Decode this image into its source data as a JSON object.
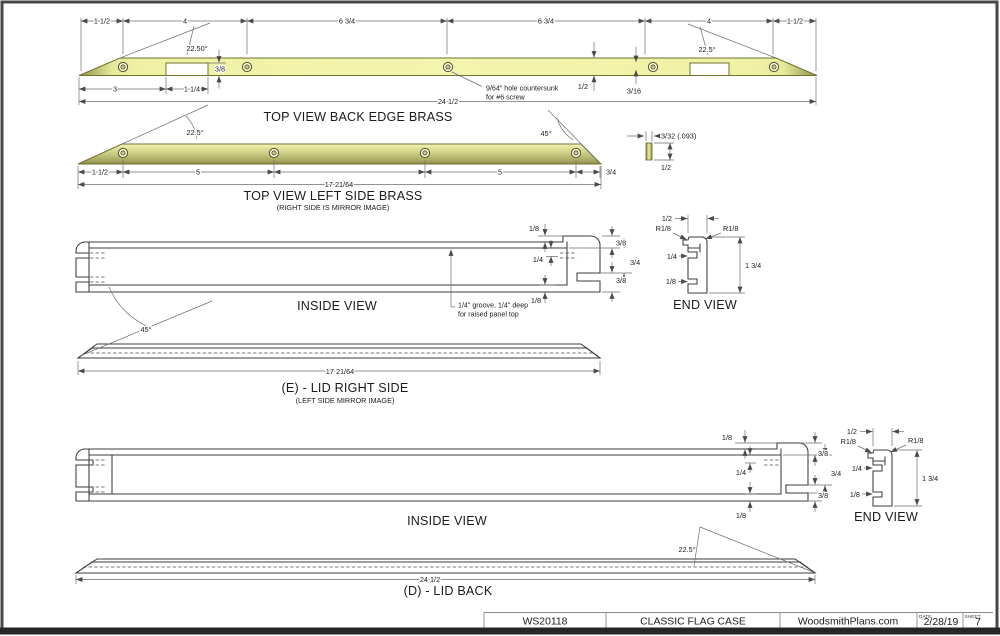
{
  "back_edge": {
    "title": "TOP VIEW BACK EDGE BRASS",
    "seg1": "1 1/2",
    "seg2": "4",
    "seg3": "6 3/4",
    "seg4": "6 3/4",
    "seg5": "4",
    "seg6": "1 1/2",
    "angle_left": "22.50°",
    "angle_right": "22.5°",
    "notch_depth": "3/8",
    "tip_to_notch": "3",
    "notch_width": "1 1/4",
    "bar_width": "1/2",
    "hole_inset": "3/16",
    "overall": "24 1/2",
    "hole_note_1": "9/64\" hole countersunk",
    "hole_note_2": "for #6 screw"
  },
  "left_side": {
    "title": "TOP VIEW LEFT SIDE BRASS",
    "subtitle": "(RIGHT SIDE IS MIRROR IMAGE)",
    "angle_left": "22.5°",
    "angle_right": "45°",
    "seg1": "1 1/2",
    "seg2": "5",
    "seg3": "5",
    "seg4": "3/4",
    "overall": "17 21/64"
  },
  "strip": {
    "thickness": "3/32 (.093)",
    "width": "1/2"
  },
  "lid_side": {
    "inside_label": "INSIDE VIEW",
    "top_lip": "1/8",
    "cap_step": "3/8",
    "groove_depth": "1/4",
    "mid": "3/4",
    "lower_step": "3/8",
    "bottom_lip": "1/8",
    "groove_note_1": "1/4\" groove, 1/4\" deep",
    "groove_note_2": "for raised panel top",
    "end": {
      "label": "END VIEW",
      "width": "1/2",
      "radius_left": "R1/8",
      "radius_right": "R1/8",
      "groove": "1/4",
      "lip": "1/8",
      "height": "1 3/4"
    },
    "angle": "45°",
    "overall": "17 21/64",
    "title": "(E) - LID RIGHT SIDE",
    "subtitle": "(LEFT SIDE MIRROR IMAGE)"
  },
  "lid_back": {
    "inside_label": "INSIDE VIEW",
    "top_lip": "1/8",
    "cap_step": "3/8",
    "groove_depth": "1/4",
    "mid": "3/4",
    "lower_step": "3/8",
    "bottom_lip": "1/8",
    "end": {
      "label": "END VIEW",
      "width": "1/2",
      "radius_left": "R1/8",
      "radius_right": "R1/8",
      "groove": "1/4",
      "lip": "1/8",
      "height": "1 3/4"
    },
    "angle": "22.5°",
    "overall": "24 1/2",
    "title": "(D) - LID BACK"
  },
  "title_block": {
    "code": "WS20118",
    "name": "CLASSIC FLAG CASE",
    "site": "WoodsmithPlans.com",
    "date_label": "DATE",
    "date": "2/28/19",
    "sheet_label": "SHEET",
    "sheet": "7"
  },
  "colors": {
    "brass_light": "#f3f5af",
    "brass_dark": "#90914a",
    "line": "#3c3c3c"
  }
}
